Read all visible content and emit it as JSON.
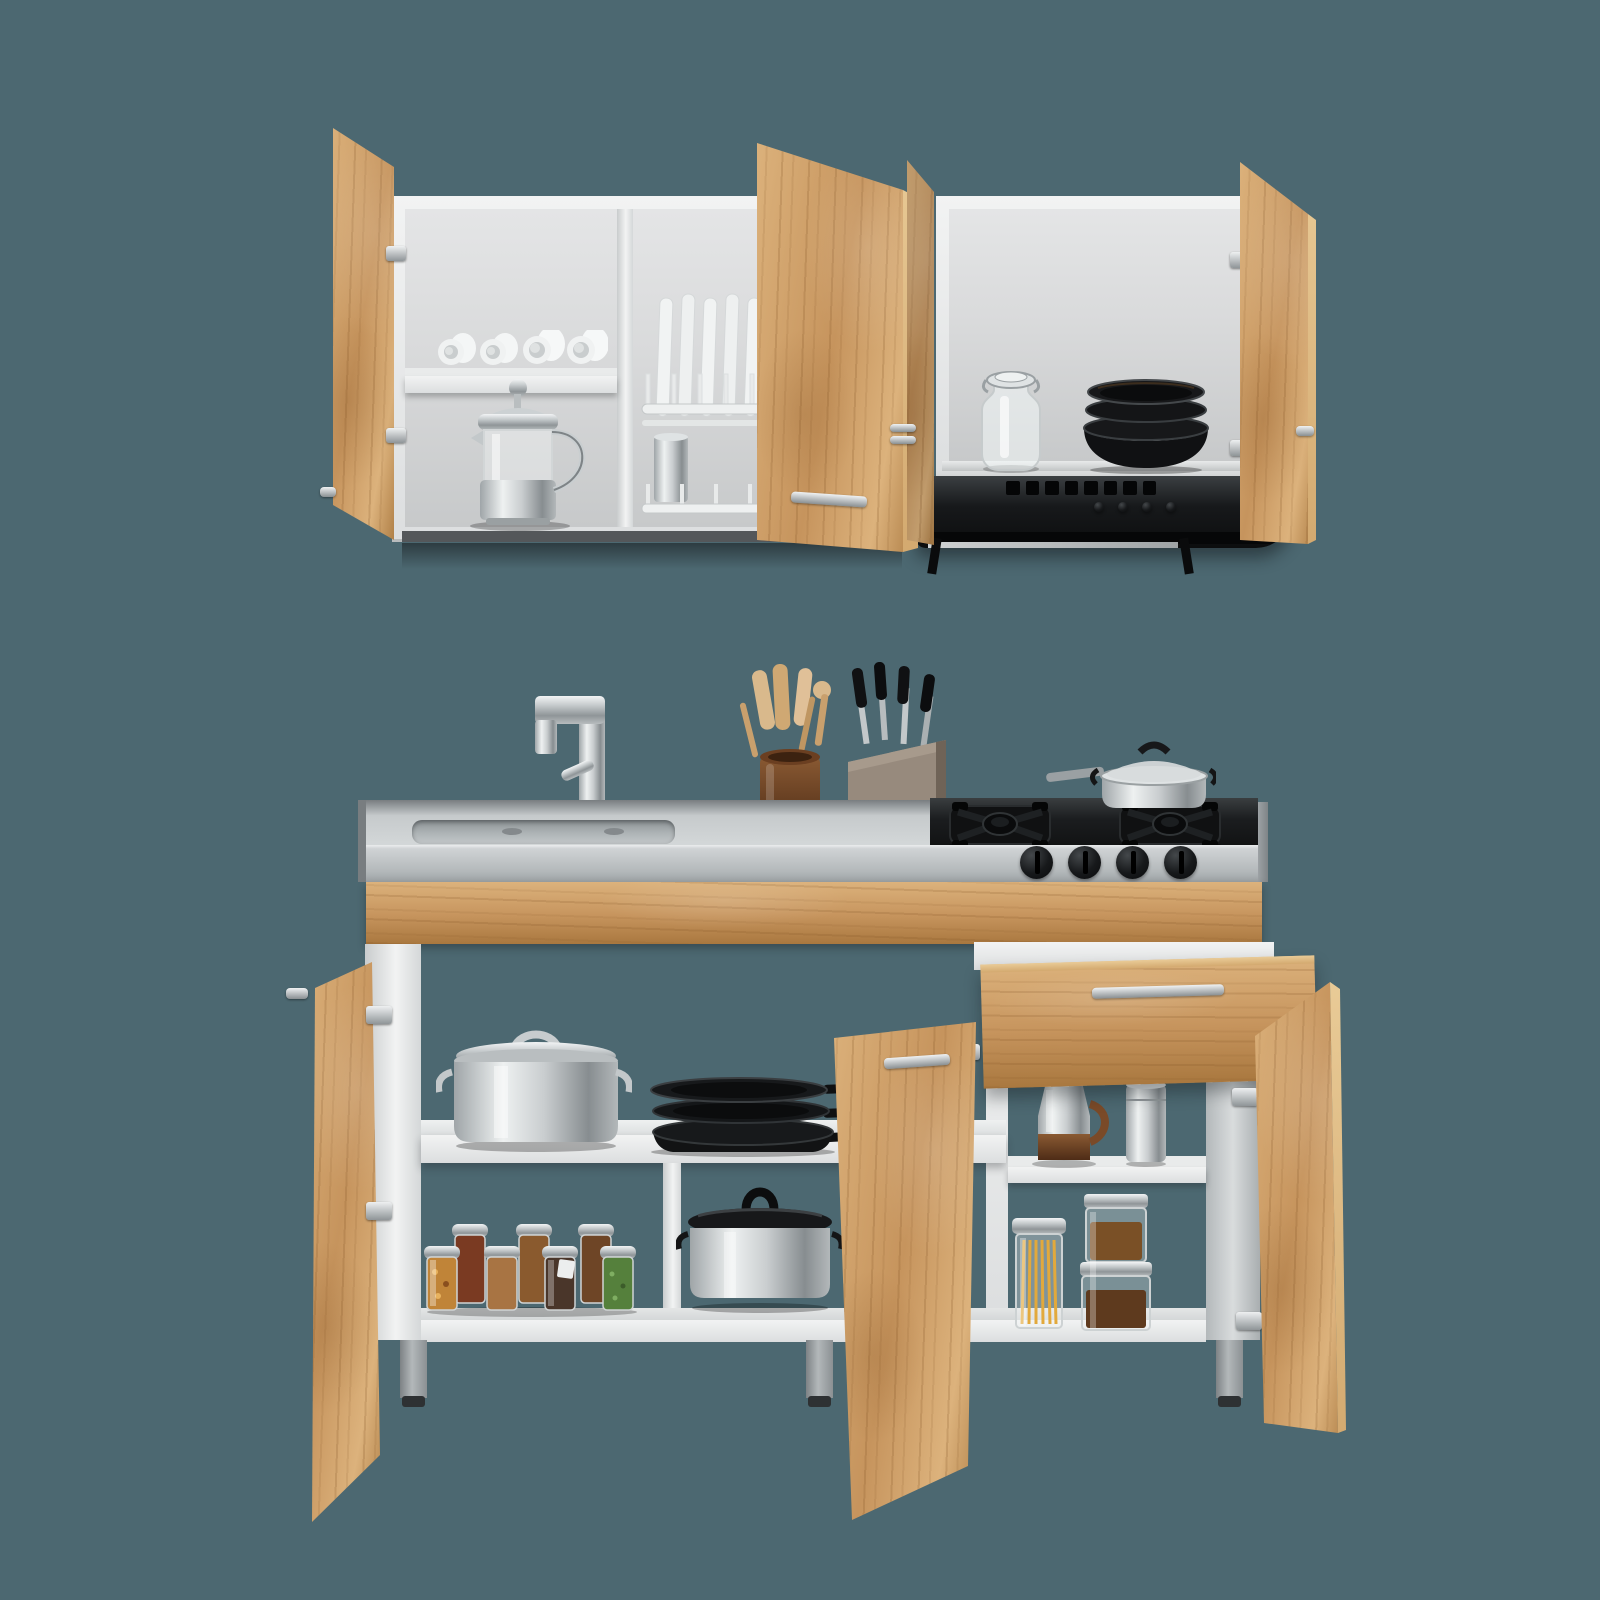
{
  "title": "Kitchen cabinet set product photo",
  "canvas": {
    "width": 1600,
    "height": 1600
  },
  "palette": {
    "bg": "#4c6871",
    "wood-light": "#dcb27c",
    "wood-mid": "#c6945d",
    "wood-dark": "#a9783f",
    "wood-edge": "#e9cb97",
    "white": "#f2f3f3",
    "white-shade": "#dcdedf",
    "interior": "#d9dadb",
    "interior-dark": "#c7c9ca",
    "steel-light": "#d6d9da",
    "steel-mid": "#aab0b2",
    "steel-dark": "#7e8487",
    "counter-face": "#c9cdcf",
    "cooktop": "#232628",
    "cookware-black": "#131416",
    "hood-black": "#1a1c1e",
    "chrome": "#eef1f2",
    "crock-brown": "#7a4a28",
    "utensil-tan": "#d9b98c",
    "pasta-yellow": "#e2a93c",
    "spice-orange": "#c08438",
    "spice-red": "#7a3a22",
    "spice-tan": "#a87443",
    "spice-seed": "#8a5a2e",
    "spice-dark": "#4a362a",
    "spice-green": "#55803c",
    "coffee-brown": "#6e4426"
  },
  "scene": {
    "wall_unit": {
      "left_cabinet": {
        "open_door_count": 2,
        "compartments": 2,
        "shelf_items": [
          "four-white-cups",
          "french-press"
        ],
        "rack_items": [
          "five-white-plates",
          "two-gray-plates",
          "steel-tumbler"
        ]
      },
      "right_cabinet": {
        "open_door_count": 2,
        "items": [
          "glass-clip-jar",
          "stack-of-four-black-bowls"
        ],
        "appliance": "under-cabinet-range-hood",
        "hood_buttons": 4
      }
    },
    "base_unit": {
      "countertop": {
        "items": [
          "inset-steel-sink",
          "chrome-faucet",
          "utensil-crock",
          "wooden-utensils",
          "knife-block",
          "gas-cooktop-two-burners",
          "lidded-saute-pan"
        ],
        "control_knob_count": 4
      },
      "left_section": {
        "middle_shelf": [
          "lidded-stockpot",
          "three-black-fry-pans"
        ],
        "bottom_shelf": [
          "seven-spice-jars",
          "silver-pot-with-black-lid"
        ]
      },
      "right_section": {
        "drawer_state": "open",
        "middle_shelf": [
          "coffee-carafe",
          "steel-canister"
        ],
        "bottom_shelf": [
          "spaghetti-canister",
          "two-stacked-food-canisters"
        ]
      },
      "open_door_count": 3,
      "visible_leg_count": 3
    }
  }
}
